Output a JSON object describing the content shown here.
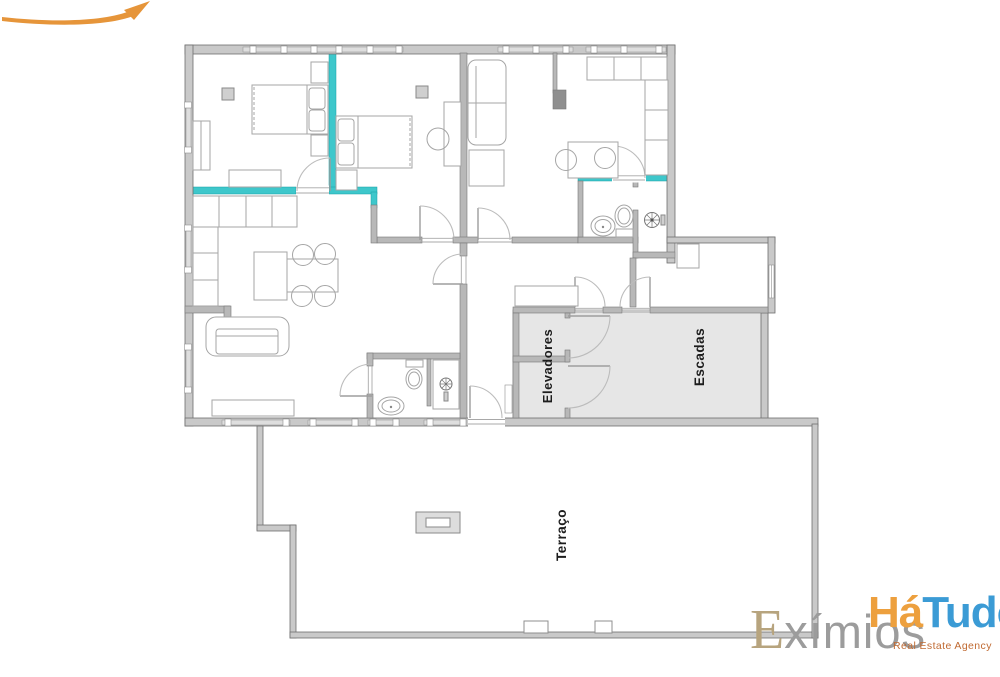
{
  "plan": {
    "labels": {
      "elevators": "Elevadores",
      "stairs": "Escadas",
      "terrace": "Terraço"
    },
    "colors": {
      "highlight_teal": "#3EC7CB",
      "wall_gray": "#B8B8B8",
      "shaded_room_gray": "#E6E6E6"
    }
  },
  "branding": {
    "watermark_initial": "E",
    "watermark_rest": "xímios",
    "agency_name_first": "Há",
    "agency_name_second": "Tudo",
    "tagline": "Real Estate Agency",
    "colors": {
      "orange": "#EDA03E",
      "blue": "#3B9BD5",
      "watermark_gray": "#9C9C9C",
      "watermark_tan": "#B7A47E"
    }
  }
}
